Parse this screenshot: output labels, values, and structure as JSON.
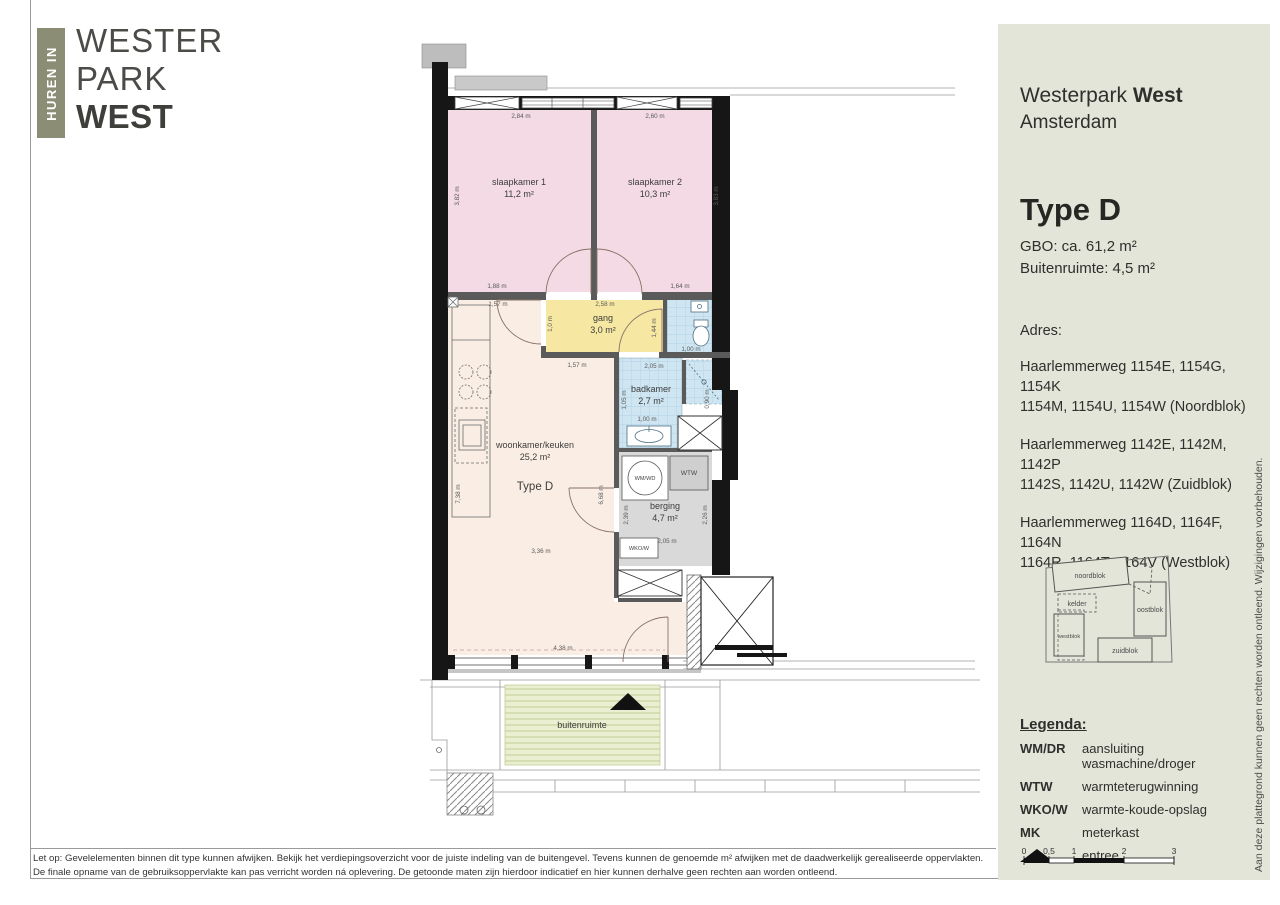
{
  "logo": {
    "tab": "HUREN IN",
    "line1": "WESTER",
    "line2": "PARK",
    "line3": "WEST"
  },
  "sidebar": {
    "project_regular": "Westerpark ",
    "project_bold": "West",
    "city": "Amsterdam",
    "type_title": "Type D",
    "gbo": "GBO: ca. 61,2 m²",
    "buitenruimte": "Buitenruimte: 4,5 m²",
    "adres_label": "Adres:",
    "addresses": [
      {
        "line1": "Haarlemmerweg 1154E, 1154G, 1154K",
        "line2": "1154M, 1154U, 1154W  (Noordblok)"
      },
      {
        "line1": "Haarlemmerweg 1142E, 1142M, 1142P",
        "line2": "1142S, 1142U, 1142W  (Zuidblok)"
      },
      {
        "line1": "Haarlemmerweg 1164D, 1164F, 1164N",
        "line2": "1164R, 1164T, 1164V  (Westblok)"
      }
    ],
    "sitemap": {
      "noordblok": "noordblok",
      "kelder": "kelder",
      "oostblok": "oostblok",
      "westblok": "westblok",
      "zuidblok": "zuidblok"
    },
    "legend": {
      "title": "Legenda:",
      "items": [
        {
          "key": "WM/DR",
          "label": "aansluiting wasmachine/droger"
        },
        {
          "key": "WTW",
          "label": "warmteterugwinning"
        },
        {
          "key": "WKO/W",
          "label": "warmte-koude-opslag"
        },
        {
          "key": "MK",
          "label": "meterkast"
        }
      ],
      "entree_label": "entree"
    },
    "scalebar": {
      "ticks": [
        "0",
        "0,5",
        "1",
        "2",
        "3"
      ]
    },
    "side_note": "Aan deze plattegrond kunnen geen rechten worden ontleend. Wijzigingen voorbehouden."
  },
  "plan": {
    "rooms": {
      "slaapkamer1": {
        "name": "slaapkamer 1",
        "area": "11,2 m²"
      },
      "slaapkamer2": {
        "name": "slaapkamer 2",
        "area": "10,3 m²"
      },
      "gang": {
        "name": "gang",
        "area": "3,0 m²"
      },
      "badkamer": {
        "name": "badkamer",
        "area": "2,7 m²"
      },
      "woonkamer": {
        "name": "woonkamer/keuken",
        "area": "25,2 m²"
      },
      "type_label": "Type D",
      "berging": {
        "name": "berging",
        "area": "4,7 m²"
      },
      "buitenruimte": {
        "name": "buitenruimte"
      }
    },
    "fixtures": {
      "wmwd": "WM/WD",
      "wtw": "WTW",
      "wkow": "WKO/W"
    },
    "dims": {
      "d284": "2,84 m",
      "d260": "2,60 m",
      "d382": "3,82 m",
      "d383": "3,83 m",
      "d188": "1,88 m",
      "d164": "1,64 m",
      "d157a": "1,57 m",
      "d258": "2,58 m",
      "d10": "1,0 m",
      "d144": "1,44 m",
      "d100t": "1,00 m",
      "d157b": "1,57 m",
      "d205b": "2,05 m",
      "d105": "1,05 m",
      "d100b": "1,00 m",
      "d090": "0,90 m",
      "d738": "7,38 m",
      "d668": "6,68 m",
      "d239": "2,39 m",
      "d226": "2,26 m",
      "d205g": "2,05 m",
      "d336": "3,36 m",
      "d438": "4,38 m"
    }
  },
  "footer": {
    "line1": "Let op: Gevelelementen binnen dit type kunnen afwijken. Bekijk het verdiepingsoverzicht voor de juiste indeling van de buitengevel. Tevens kunnen de genoemde m² afwijken met de daadwerkelijk gerealiseerde oppervlakten.",
    "line2": "De finale opname van de gebruiksoppervlakte kan pas verricht worden ná oplevering. De getoonde maten zijn hierdoor indicatief en hier kunnen derhalve geen rechten aan worden ontleend."
  }
}
